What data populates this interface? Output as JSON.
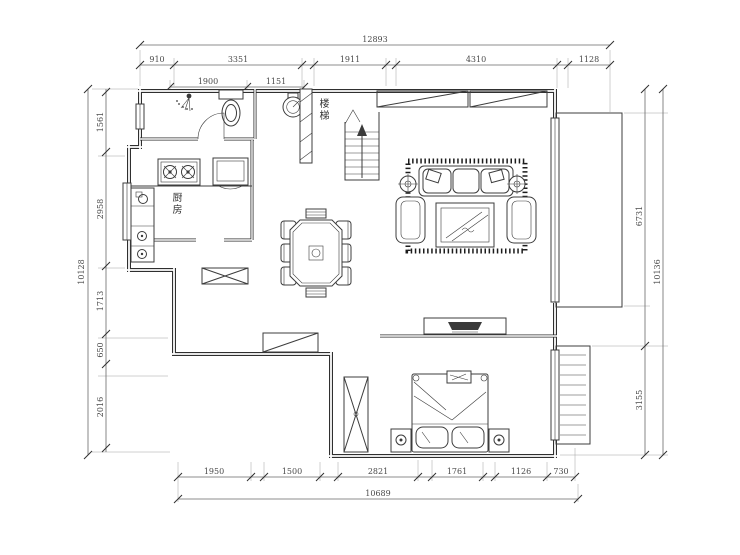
{
  "labels": {
    "kitchen": "厨房",
    "stairs": "楼梯"
  },
  "dims": {
    "top_overall": "12893",
    "top_segments": [
      "910",
      "3351",
      "1911",
      "4310",
      "1128"
    ],
    "top_inner": [
      "1900",
      "1151"
    ],
    "left_overall": "10128",
    "left_segments": [
      "1561",
      "2958",
      "1713",
      "650",
      "2016"
    ],
    "right_overall": "10136",
    "right_segments": [
      "6731",
      "3155"
    ],
    "bottom_overall": "10689",
    "bottom_segments": [
      "1950",
      "1500",
      "2821",
      "1761",
      "1126",
      "730"
    ]
  },
  "colors": {
    "wall": "#2f2f2f",
    "dimension": "#6a6a6a",
    "background": "#ffffff"
  }
}
